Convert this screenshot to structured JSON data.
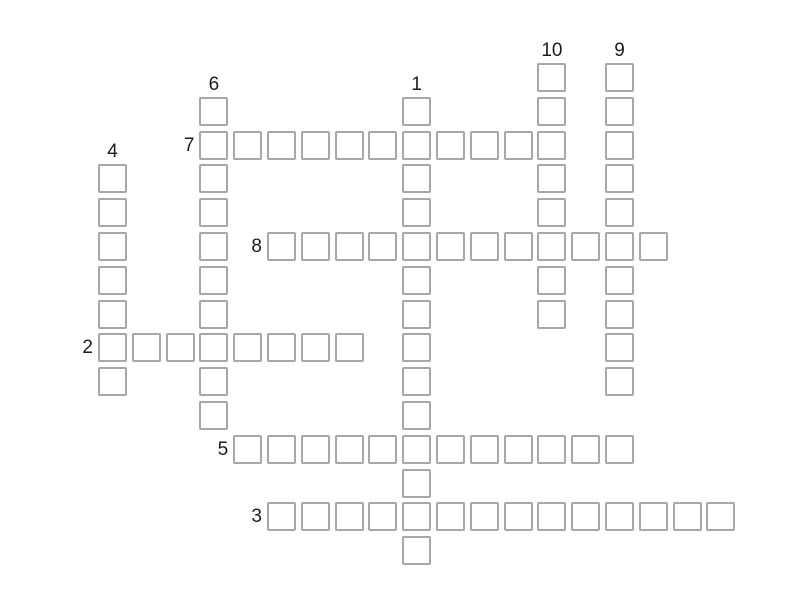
{
  "page": {
    "background_color": "#ffffff",
    "kind": "empty crossword puzzle grid"
  },
  "puzzle": {
    "cell_fill_color": "#ffffff",
    "cell_border_color": "#a7a7a7",
    "number_color": "#1c1c1c",
    "cells_are_empty": true,
    "entries": [
      {
        "number": "10",
        "direction": "down",
        "row": 0,
        "col": 13,
        "length": 8
      },
      {
        "number": "9",
        "direction": "down",
        "row": 0,
        "col": 15,
        "length": 10
      },
      {
        "number": "6",
        "direction": "down",
        "row": 1,
        "col": 3,
        "length": 10
      },
      {
        "number": "1",
        "direction": "down",
        "row": 1,
        "col": 9,
        "length": 14
      },
      {
        "number": "4",
        "direction": "down",
        "row": 3,
        "col": 0,
        "length": 7
      },
      {
        "number": "7",
        "direction": "across",
        "row": 2,
        "col": 3,
        "length": 11
      },
      {
        "number": "8",
        "direction": "across",
        "row": 5,
        "col": 5,
        "length": 12
      },
      {
        "number": "2",
        "direction": "across",
        "row": 8,
        "col": 0,
        "length": 8
      },
      {
        "number": "5",
        "direction": "across",
        "row": 11,
        "col": 4,
        "length": 12
      },
      {
        "number": "3",
        "direction": "across",
        "row": 13,
        "col": 5,
        "length": 14
      }
    ]
  }
}
